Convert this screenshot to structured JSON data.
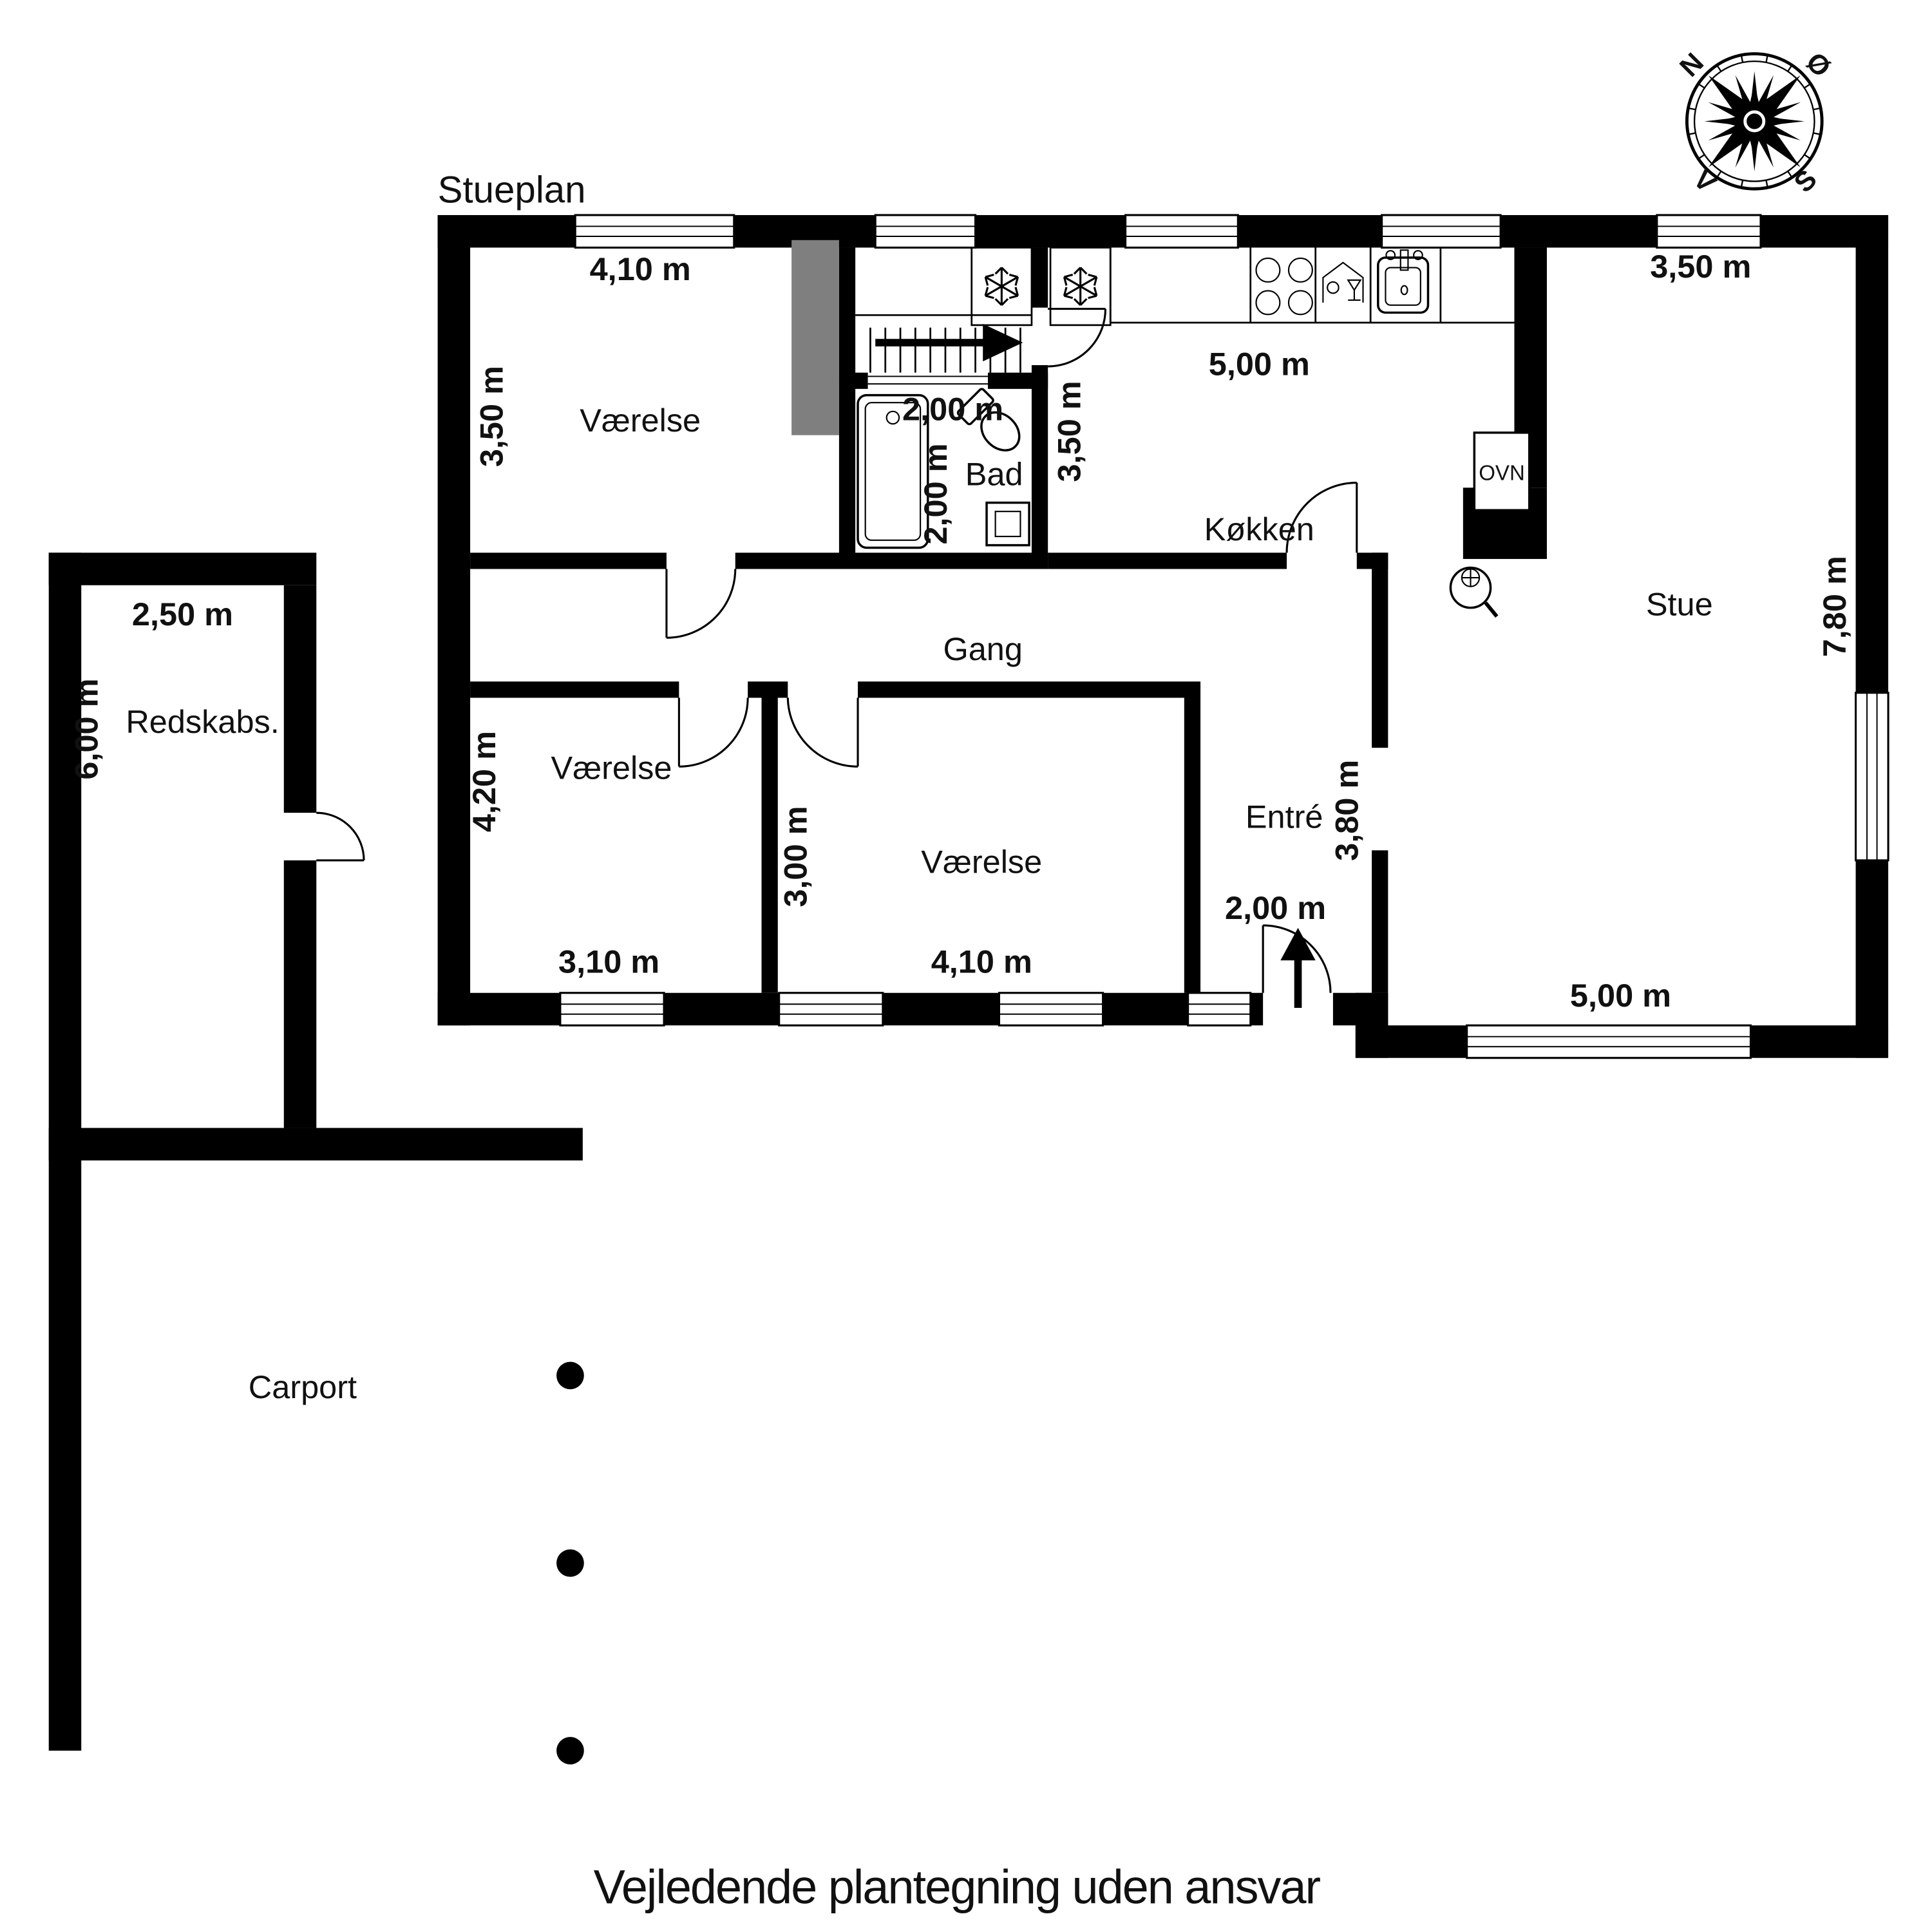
{
  "page": {
    "title": "Stueplan",
    "disclaimer": "Vejledende plantegning uden ansvar"
  },
  "compass": {
    "north": "N",
    "east": "Ø",
    "south": "S",
    "west": "V"
  },
  "rooms": {
    "bedroom_nw": {
      "name": "Værelse",
      "dim_width": "4,10 m",
      "dim_height": "3,50 m"
    },
    "bath": {
      "name": "Bad",
      "dim_width": "2,00 m",
      "dim_height": "2,00 m"
    },
    "kitchen": {
      "name": "Køkken",
      "dim_width": "5,00 m",
      "dim_height": "3,50 m",
      "oven_label": "OVN"
    },
    "living_room": {
      "name": "Stue",
      "dim_top": "3,50 m",
      "dim_right": "7,80 m",
      "dim_bottom": "5,00 m"
    },
    "hallway": {
      "name": "Gang"
    },
    "entry": {
      "name": "Entré",
      "dim_height": "3,80 m",
      "dim_door": "2,00 m"
    },
    "bedroom_w": {
      "name": "Værelse",
      "dim_height": "4,20 m",
      "dim_width": "3,10 m"
    },
    "bedroom_s": {
      "name": "Værelse",
      "dim_height": "3,00 m",
      "dim_width": "4,10 m"
    },
    "shed": {
      "name": "Redskabs.",
      "dim_width": "2,50 m",
      "dim_height": "6,00 m"
    },
    "carport": {
      "name": "Carport"
    }
  }
}
